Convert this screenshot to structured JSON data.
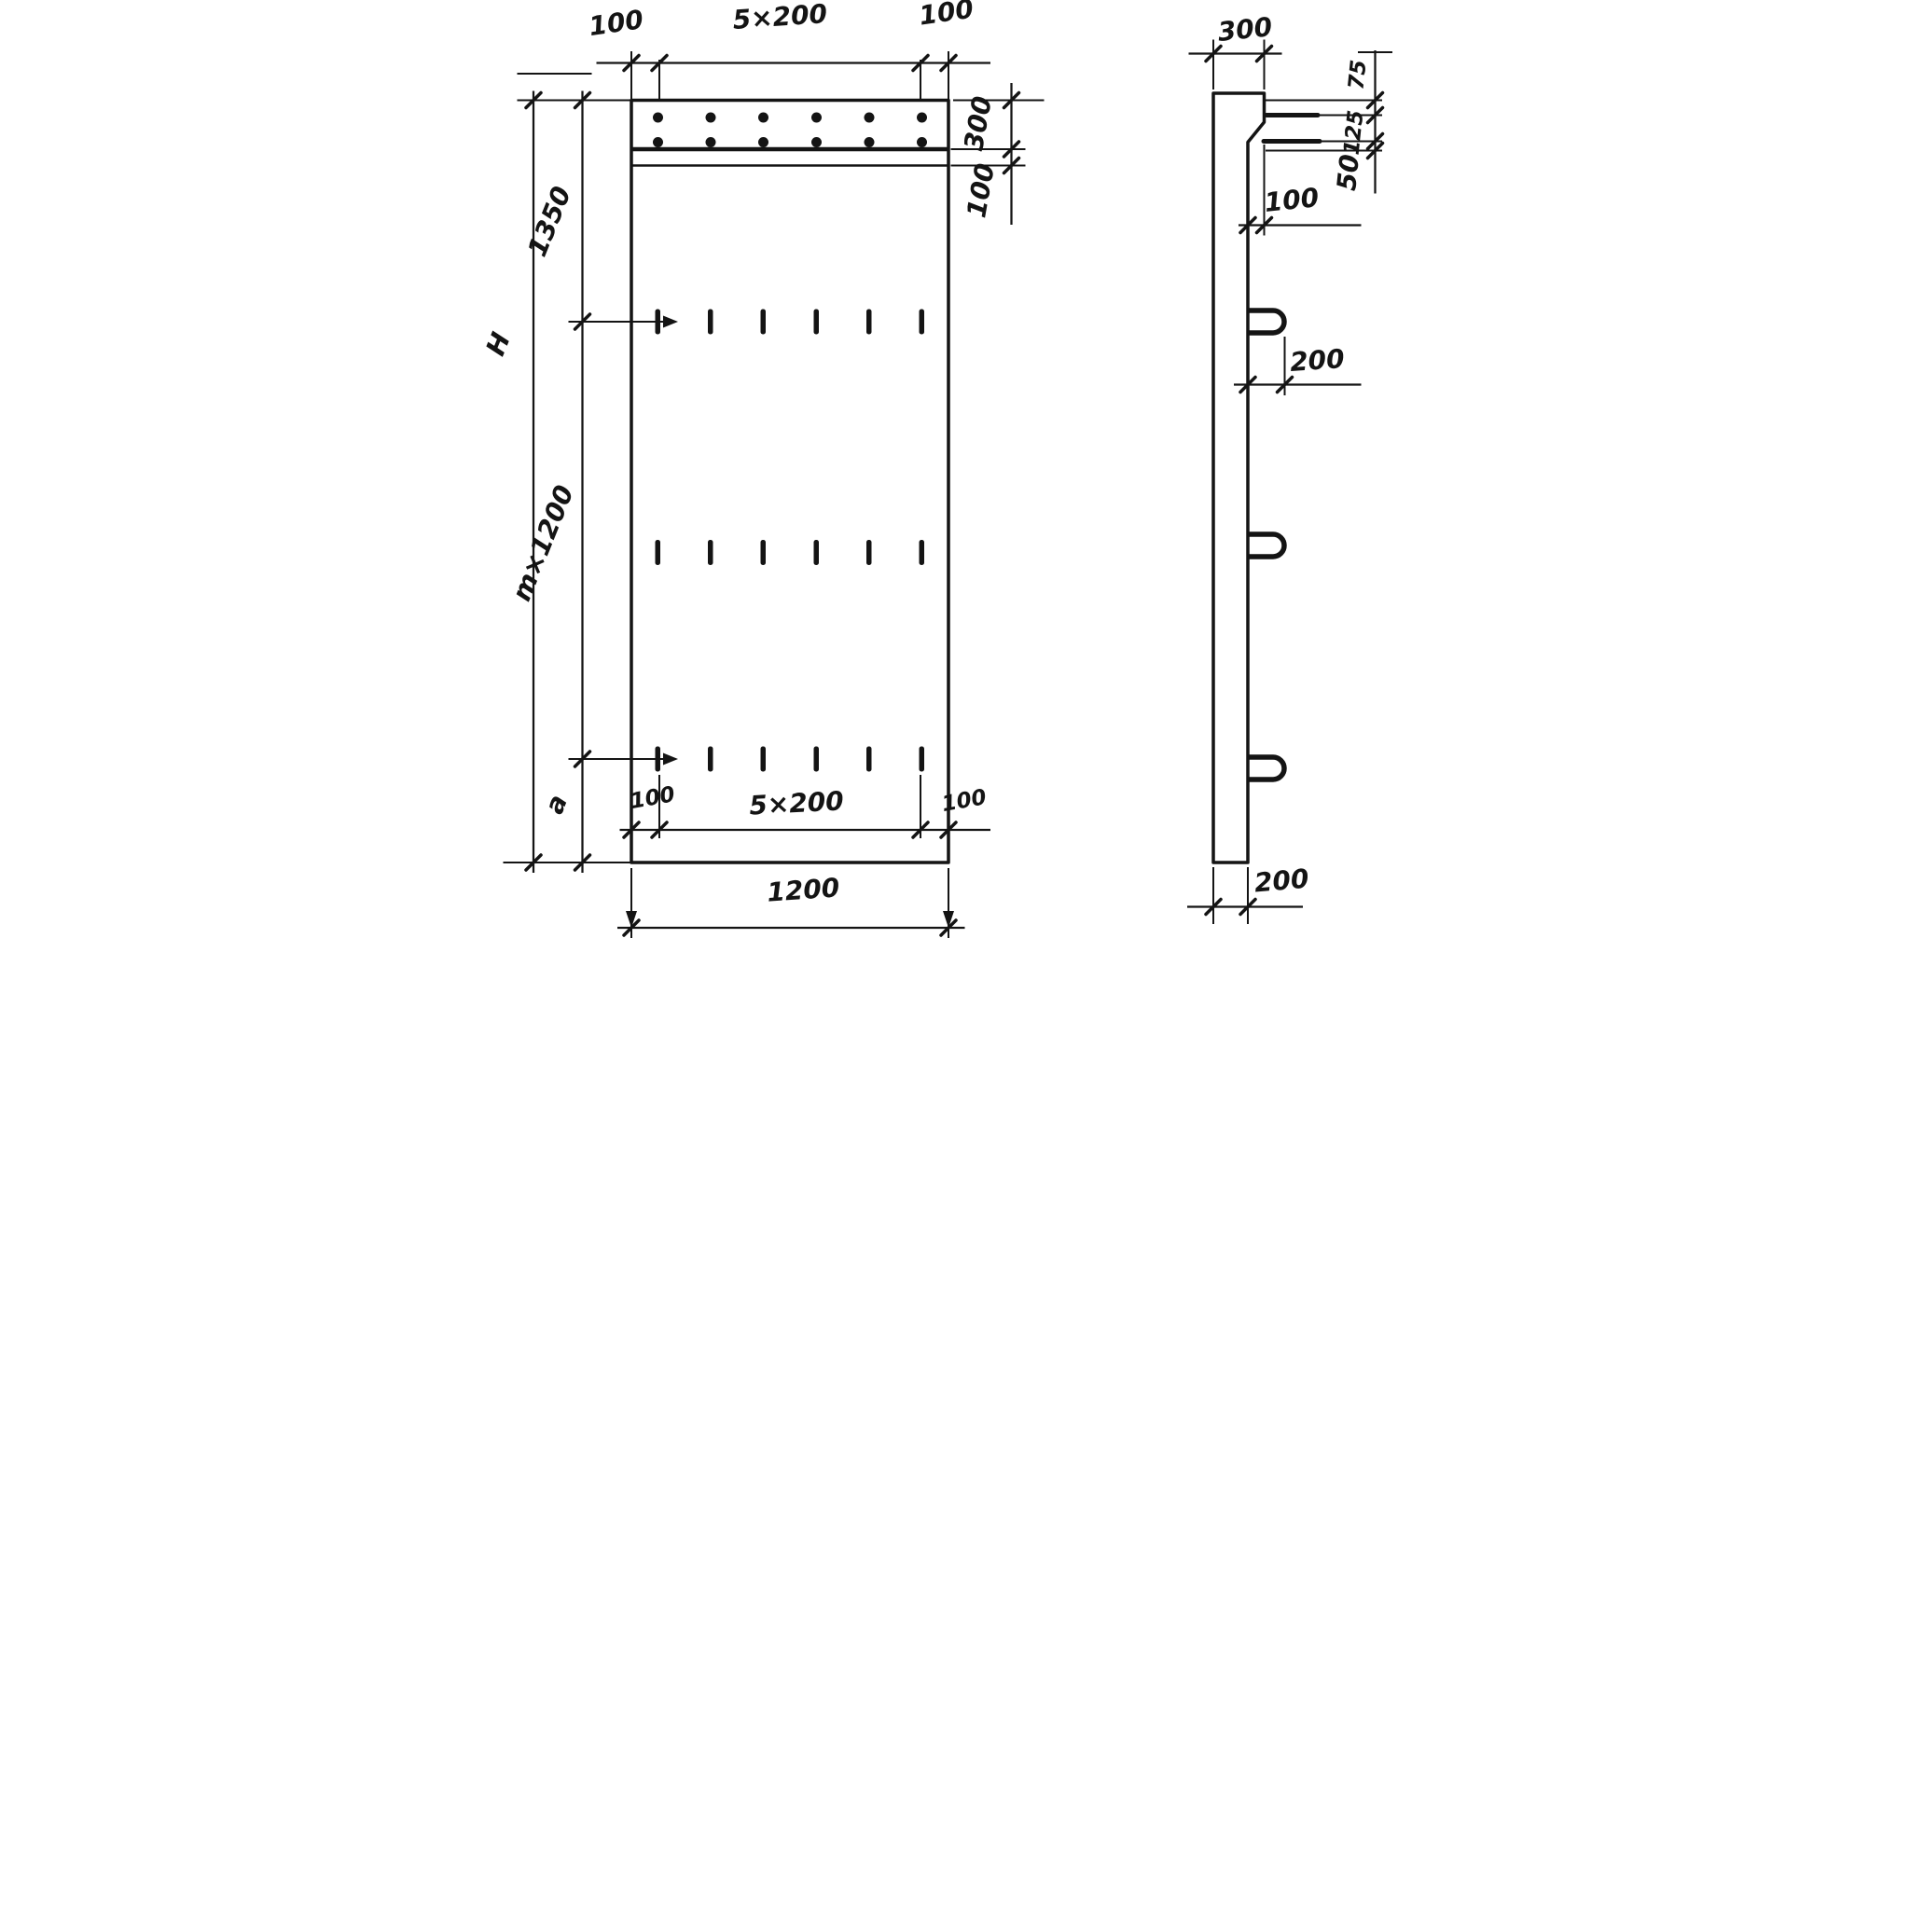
{
  "front": {
    "top_dim": {
      "left": "100",
      "span": "5×200",
      "right": "100"
    },
    "right_dim": {
      "band": "300",
      "strip": "100"
    },
    "left_dim": {
      "overall": "H",
      "upper": "1350",
      "middle": "m×1200",
      "lower": "a"
    },
    "inner_bottom_dim": {
      "left": "100",
      "span": "5×200",
      "right": "100"
    },
    "bottom_dim": {
      "width": "1200"
    }
  },
  "side": {
    "top_dim": {
      "width": "300"
    },
    "right_dim": {
      "first": "75",
      "second": "125",
      "third": "50"
    },
    "step_dim": "100",
    "loop_dim": "200",
    "bottom_dim": "200"
  }
}
